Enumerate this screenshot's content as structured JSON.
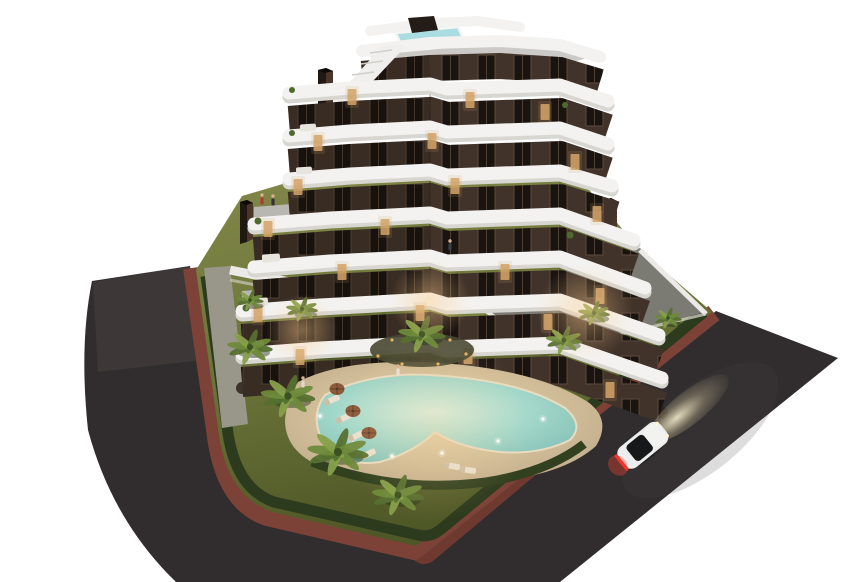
{
  "scene": {
    "title": "aerial-dusk-render-apartment-complex-with-lagoon-pool",
    "type": "3d-architectural-render",
    "colors": {
      "bg": "#ffffff",
      "road": "#312d2e",
      "road_light": "#474140",
      "bike_path": "#7d4237",
      "curb": "#ab9e8c",
      "lawn_hi": "#83894a",
      "lawn_lo": "#4e5726",
      "hedge": "#2c3a1d",
      "hedge2": "#31401f",
      "sand": "#c9b593",
      "sand_hi": "#e9d8ae",
      "pool_center": "#d8efe0",
      "pool_mid": "#a3d8ca",
      "pool_edge": "#7db9b1",
      "mulch": "#474731",
      "facade": "#42332a",
      "facade_shade": "#140d08",
      "window_dark": "#1a1411",
      "window_frame": "#5c4a3c",
      "window_lit": "#d2a368",
      "slab": "#f3f2f0",
      "slab_shadow": "#d8d6d1",
      "roof_deck": "#cbcac6",
      "rooftop_pool": "#a9dde2",
      "glass_box": "#241c16",
      "chimney": "#1f1813",
      "chimney_side": "#4a3526",
      "wall_white": "#eceae6",
      "wall_shadow": "#d8d6cf",
      "walkway": "#98978a",
      "terrace": "#7b7a73",
      "furniture": "#35322f",
      "table_light": "#d6d2c8",
      "deck_step": "#b9b7b2",
      "base_dark": "#2a211b",
      "building_shadow": "#262c14",
      "palm_dark": "#55702f",
      "palm_mid": "#6e8a3a",
      "palm_light": "#86a04a",
      "palm_core": "#3c5122",
      "palm_shadow": "#22301a",
      "umbrella": "#8a5a3b",
      "umbrella_rib": "#5f3c26",
      "lounger": "#e9e1cf",
      "lounger_pad": "#cbbfa6",
      "skin": "#d9b08c",
      "car_body": "#eceded",
      "car_glass": "#16181a",
      "taillight": "#e23126",
      "taillight_glow": "#ff4434",
      "headlight": "#fff6cf"
    },
    "building": {
      "floors": 7,
      "style": "stepped tower, dark brown facade, white curved balcony slabs",
      "rooftop_features": [
        "plunge pool",
        "access stair",
        "glass box",
        "chimneys",
        "roof terrace"
      ],
      "chimneys": 3
    },
    "pool": {
      "shape": "lagoon",
      "underwater_lights": 6
    },
    "palms": [
      [
        250,
        347,
        1.0
      ],
      [
        288,
        396,
        1.2
      ],
      [
        338,
        452,
        1.35
      ],
      [
        398,
        495,
        1.15
      ],
      [
        422,
        334,
        1.05
      ],
      [
        564,
        340,
        0.8
      ],
      [
        594,
        313,
        0.7
      ],
      [
        302,
        309,
        0.7
      ],
      [
        668,
        318,
        0.6
      ],
      [
        250,
        300,
        0.6
      ]
    ],
    "parasols": [
      [
        337,
        389
      ],
      [
        353,
        411
      ],
      [
        369,
        433
      ]
    ],
    "loungers": [
      [
        332,
        400,
        -25
      ],
      [
        344,
        418,
        -25
      ],
      [
        356,
        436,
        -25
      ],
      [
        368,
        454,
        -25
      ],
      [
        452,
        466,
        10
      ],
      [
        468,
        470,
        8
      ]
    ],
    "pool_lights": [
      [
        352,
        440
      ],
      [
        392,
        456
      ],
      [
        442,
        453
      ],
      [
        498,
        441
      ],
      [
        543,
        419
      ],
      [
        320,
        416
      ]
    ],
    "lit_windows": [
      [
        352,
        97
      ],
      [
        470,
        100
      ],
      [
        545,
        112
      ],
      [
        318,
        143
      ],
      [
        432,
        141
      ],
      [
        575,
        162
      ],
      [
        298,
        187
      ],
      [
        455,
        186
      ],
      [
        597,
        214
      ],
      [
        268,
        229
      ],
      [
        385,
        227
      ],
      [
        342,
        272
      ],
      [
        505,
        272
      ],
      [
        600,
        296
      ],
      [
        258,
        314
      ],
      [
        420,
        313
      ],
      [
        548,
        322
      ],
      [
        300,
        357
      ],
      [
        468,
        356
      ],
      [
        610,
        390
      ]
    ],
    "people": [
      [
        262,
        201,
        "#b03a30"
      ],
      [
        273,
        202,
        "#33323a"
      ],
      [
        450,
        247,
        "#3a3f4a"
      ],
      [
        303,
        384,
        "#ded8cc"
      ],
      [
        398,
        372,
        "#e8e2d6"
      ]
    ],
    "car": {
      "color": "white",
      "heading_deg": -39,
      "position": [
        642,
        446
      ]
    }
  }
}
